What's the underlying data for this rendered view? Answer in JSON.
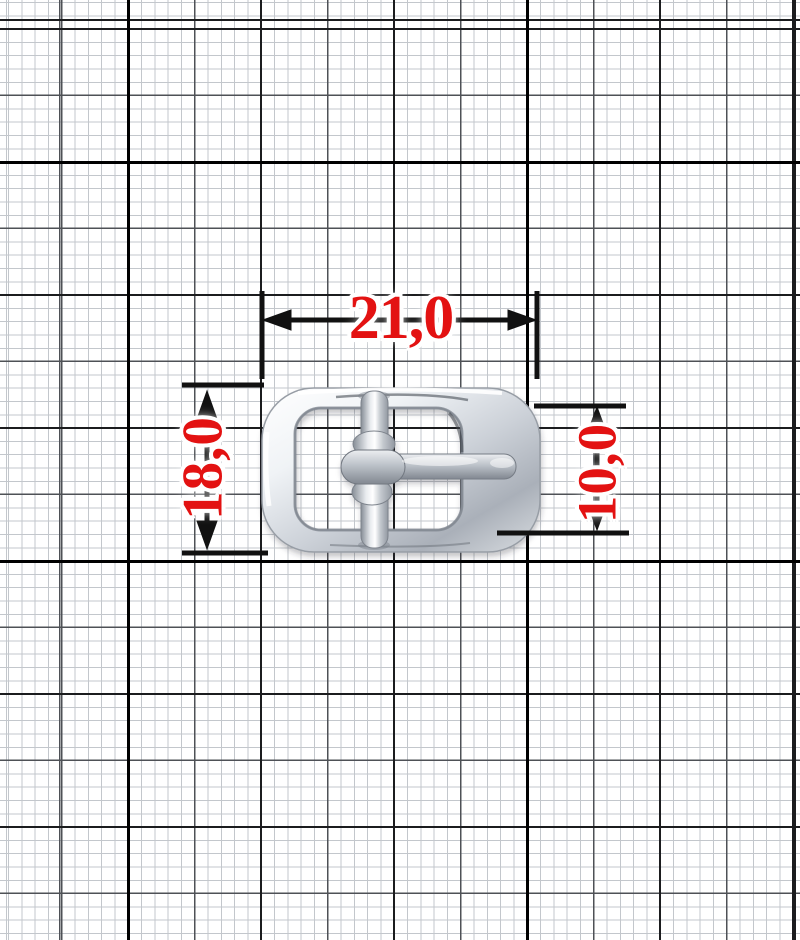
{
  "subject": {
    "type": "belt-buckle-product-photo",
    "description": "polished metal center-bar buckle with pin lying on millimeter graph paper"
  },
  "paper": {
    "background_color": "#ffffff",
    "minor_line_color": "#c3c7cc",
    "medium_line_color": "#4e5156",
    "major_line_color": "#1b1c1e",
    "heavy_line_color": "#000000"
  },
  "dimension_annotations": {
    "text_color": "#e31212",
    "halo_color": "#ffffff",
    "line_color": "#111111",
    "width_top": {
      "label": "21,0"
    },
    "height_left": {
      "label": "18,0"
    },
    "height_right": {
      "label": "10,0"
    }
  },
  "buckle": {
    "base_color": "#c9ced5",
    "highlight_color": "#ffffff",
    "shadow_color": "#8f959e"
  }
}
